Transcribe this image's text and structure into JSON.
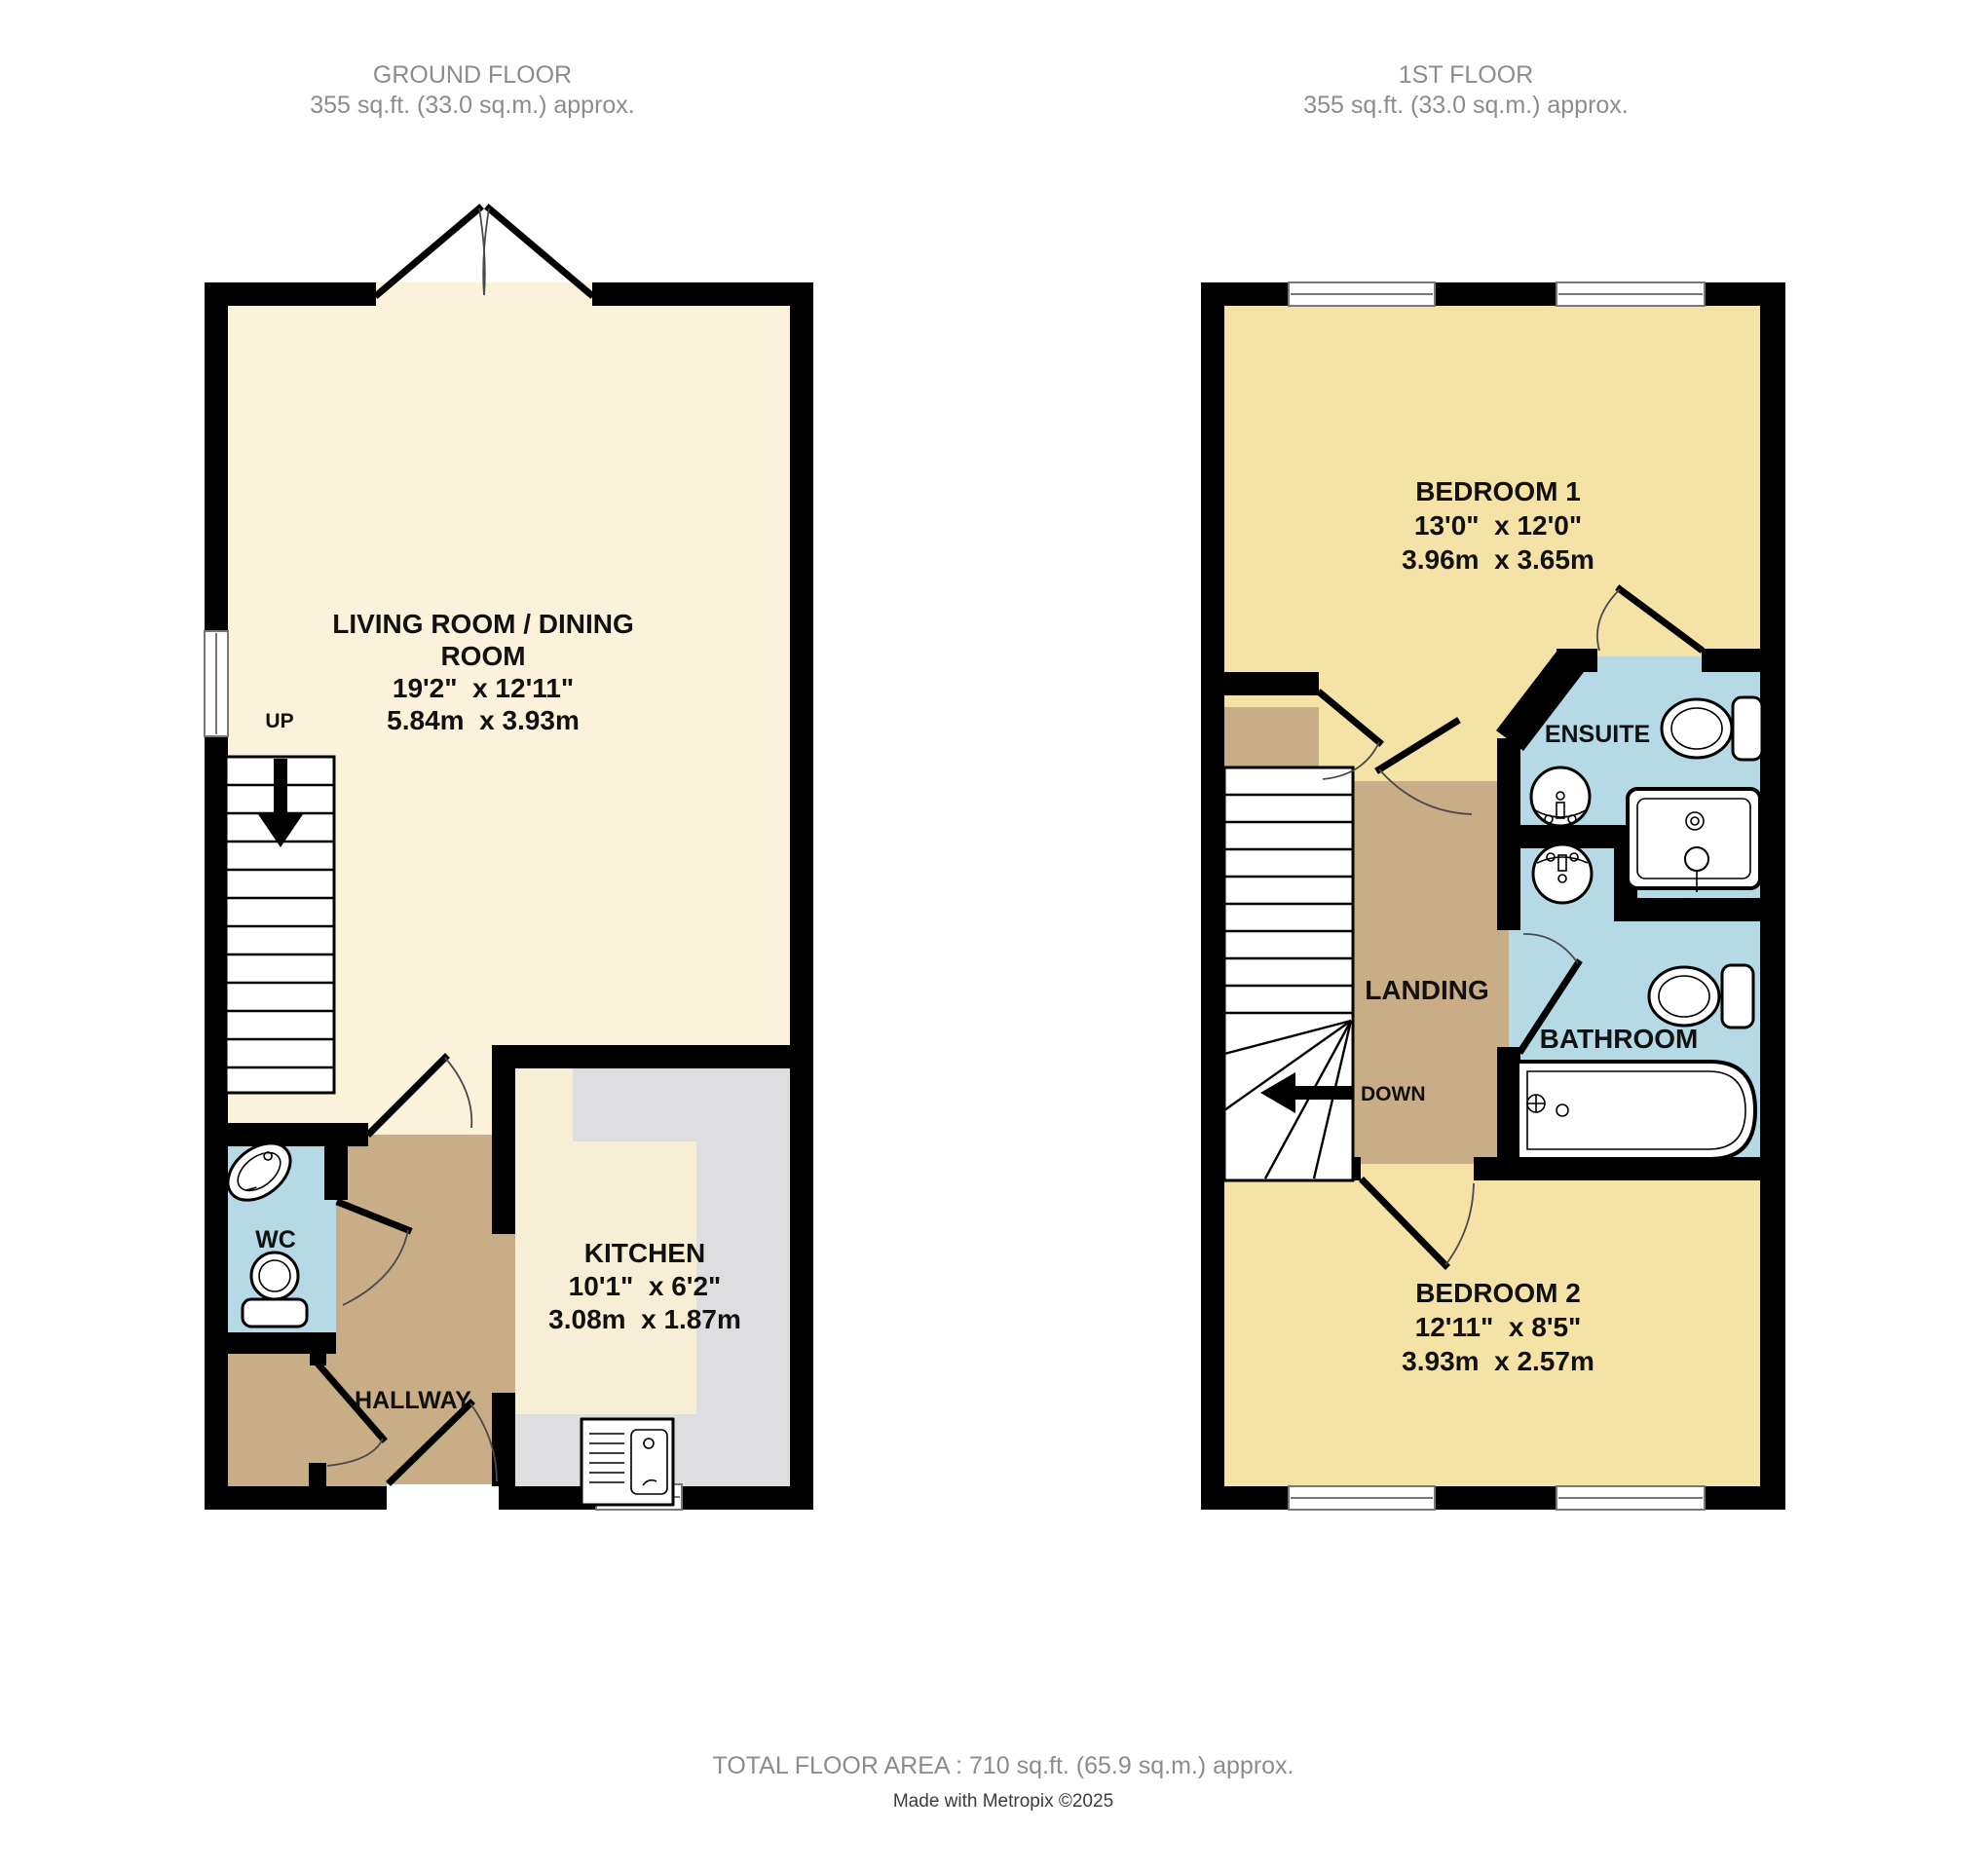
{
  "ground_floor": {
    "header": {
      "line1": "GROUND FLOOR",
      "line2": "355 sq.ft. (33.0 sq.m.) approx."
    },
    "living_room": {
      "name_line1": "LIVING ROOM / DINING",
      "name_line2": "ROOM",
      "imperial": "19'2\"  x 12'11\"",
      "metric": "5.84m  x 3.93m"
    },
    "kitchen": {
      "name": "KITCHEN",
      "imperial": "10'1\"  x 6'2\"",
      "metric": "3.08m  x 1.87m"
    },
    "wc": {
      "name": "WC"
    },
    "hallway": {
      "name": "HALLWAY"
    },
    "stairs": {
      "label": "UP"
    }
  },
  "first_floor": {
    "header": {
      "line1": "1ST FLOOR",
      "line2": "355 sq.ft. (33.0 sq.m.) approx."
    },
    "bedroom1": {
      "name": "BEDROOM 1",
      "imperial": "13'0\"  x 12'0\"",
      "metric": "3.96m  x 3.65m"
    },
    "ensuite": {
      "name": "ENSUITE"
    },
    "landing": {
      "name": "LANDING"
    },
    "bathroom": {
      "name": "BATHROOM"
    },
    "bedroom2": {
      "name": "BEDROOM 2",
      "imperial": "12'11\"  x 8'5\"",
      "metric": "3.93m  x 2.57m"
    },
    "stairs": {
      "label": "DOWN"
    }
  },
  "footer": {
    "total_area": "TOTAL FLOOR AREA : 710 sq.ft. (65.9 sq.m.) approx.",
    "credit": "Made with Metropix ©2025"
  },
  "colors": {
    "wall": "#000000",
    "living_floor": "#FAF2DB",
    "kitchen_floor": "#F7EFD5",
    "kitchen_counter": "#DEDEE0",
    "bedroom_floor": "#F5E2A6",
    "hall_floor": "#C8AD86",
    "bath_floor": "#B5DAE5",
    "header_text": "#8C8C8C",
    "label_text": "#111111",
    "credit_text": "#3C3C3C"
  }
}
